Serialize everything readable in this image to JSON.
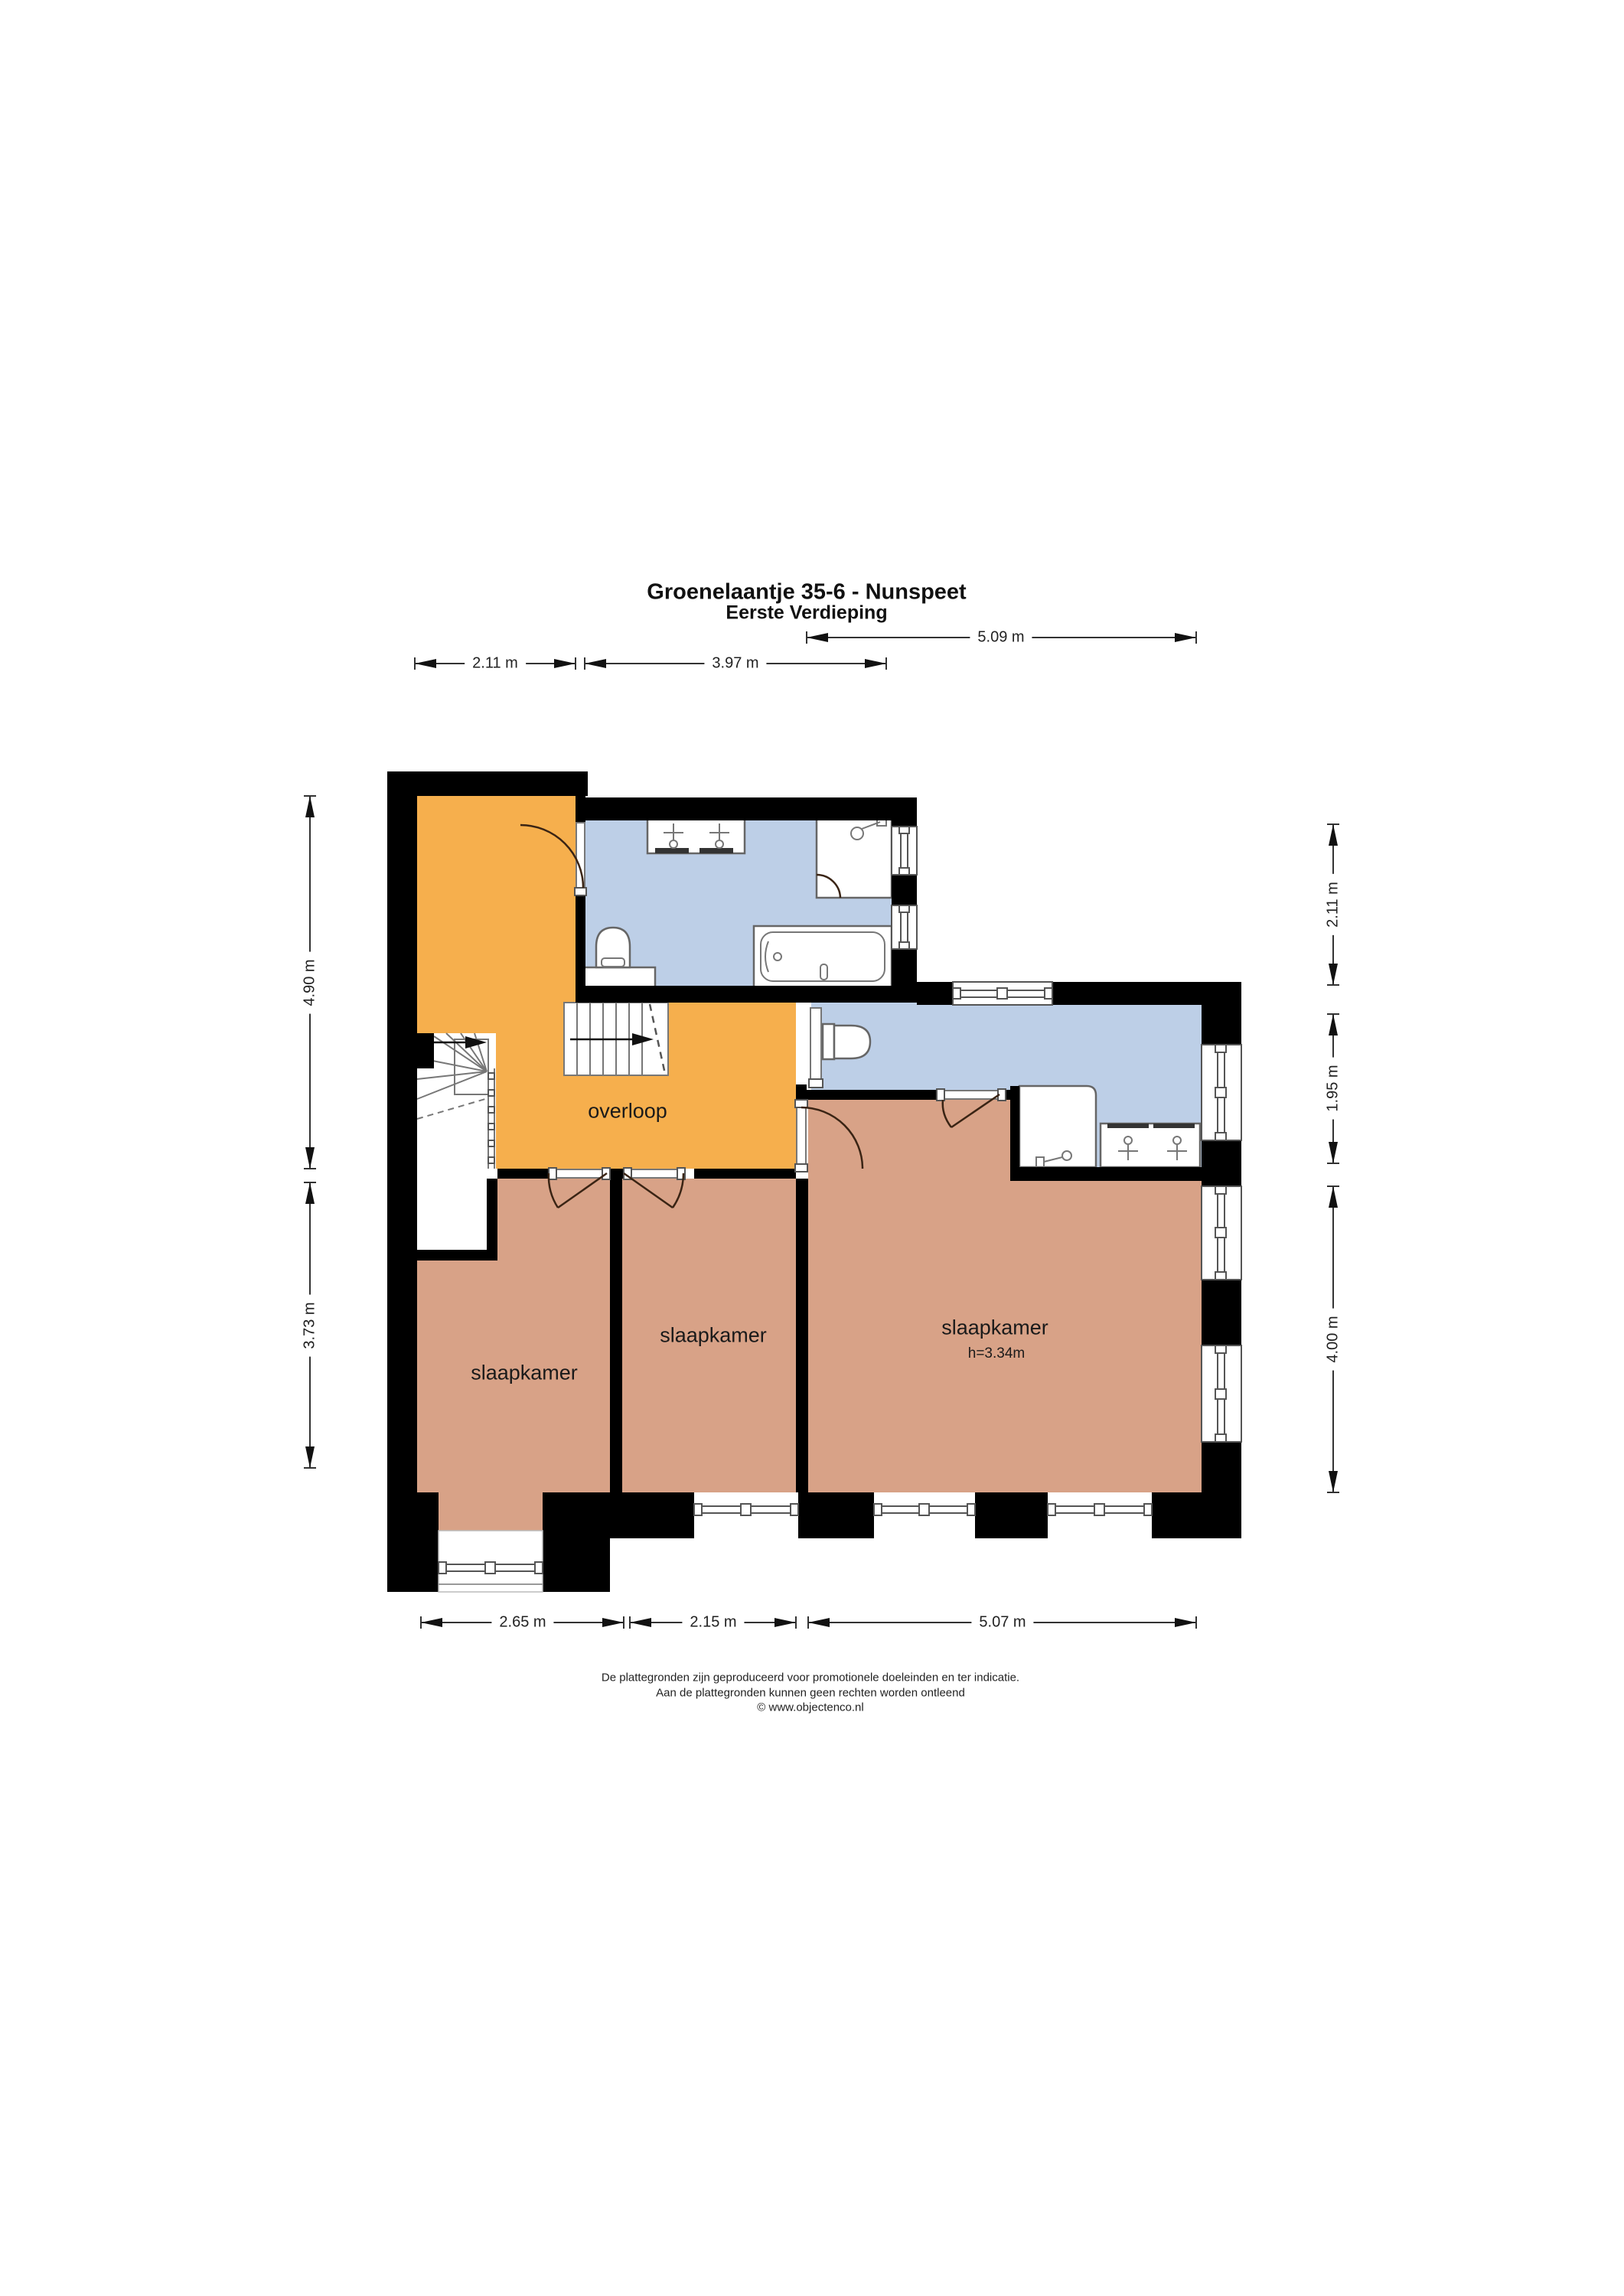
{
  "title": {
    "line1": "Groenelaantje 35-6 - Nunspeet",
    "line2": "Eerste Verdieping"
  },
  "rooms": {
    "overloop": {
      "label": "overloop"
    },
    "bedroom_left": {
      "label": "slaapkamer"
    },
    "bedroom_middle": {
      "label": "slaapkamer"
    },
    "bedroom_right": {
      "label": "slaapkamer",
      "ceiling_height": "h=3.34m"
    }
  },
  "dimensions": {
    "top": {
      "left": "2.11 m",
      "middle": "3.97 m",
      "right": "5.09 m"
    },
    "bottom": {
      "left": "2.65 m",
      "middle": "2.15 m",
      "right": "5.07 m"
    },
    "left": {
      "upper": "4.90 m",
      "lower": "3.73 m"
    },
    "right": {
      "upper": "2.11 m",
      "middle": "1.95 m",
      "lower": "4.00 m"
    }
  },
  "footer": {
    "line1": "De plattegronden zijn geproduceerd voor promotionele doeleinden en ter indicatie.",
    "line2": "Aan de plattegronden kunnen geen rechten worden ontleend",
    "line3": "© www.objectenco.nl"
  },
  "legend_icons": {
    "stairs_up_arrow": "arrow-right-icon",
    "toilet": "toilet-icon",
    "sink": "sink-faucet-icon",
    "bathtub": "bathtub-icon",
    "shower": "shower-icon"
  },
  "colors": {
    "landing_orange": "#F6AF4D",
    "bathroom_blue": "#BDCFE7",
    "bedroom_salmon": "#D8A287",
    "wall_black": "#000000",
    "door_brown": "#3A2414",
    "dimension_gray": "#333333"
  }
}
